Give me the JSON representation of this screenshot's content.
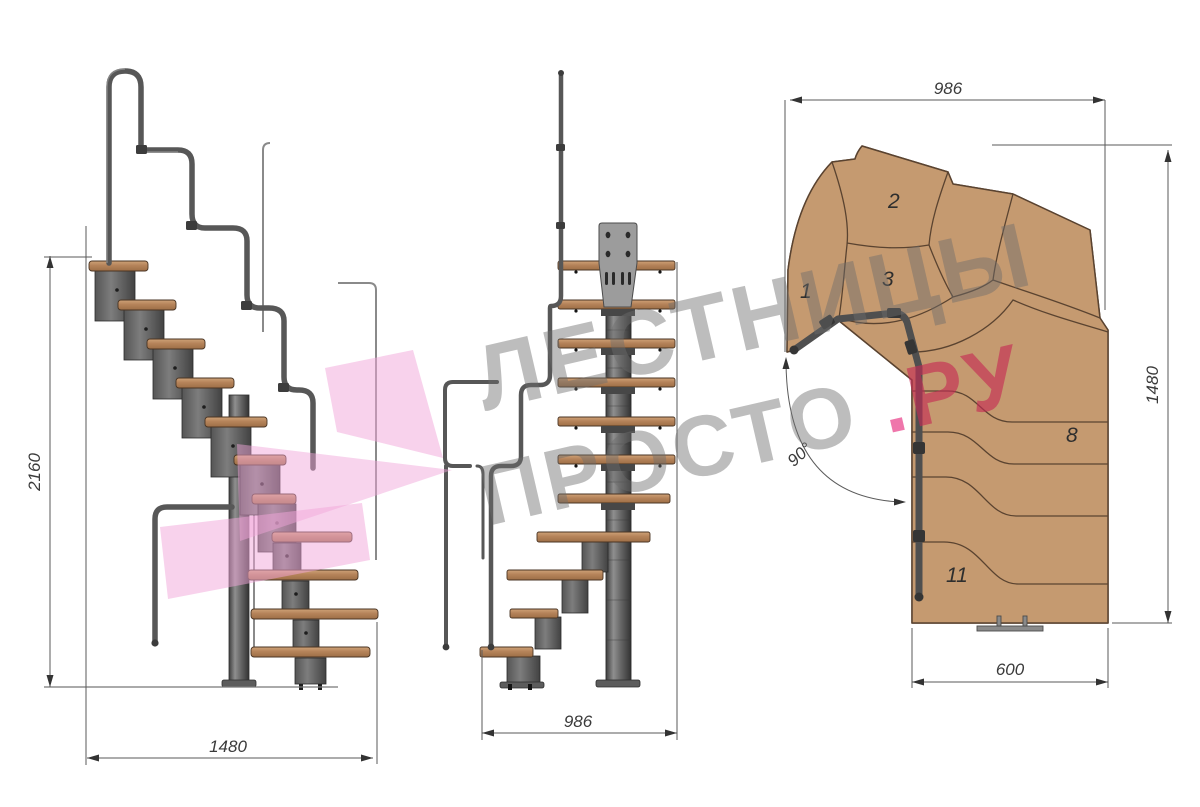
{
  "canvas": {
    "width": 1200,
    "height": 807,
    "background": "#ffffff"
  },
  "watermark": {
    "line1": "ЛЕСТНИЦЫ",
    "line2": "ПРОСТО",
    "dot": ".",
    "suffix": "РУ",
    "text_color": "#6c6c6c",
    "dot_color": "#ee6fa7",
    "suffix_color": "#c52a54",
    "logo_pink": "#f1a6da"
  },
  "views": {
    "side": {
      "dimensions": {
        "height": "2160",
        "width": "1480"
      }
    },
    "front": {
      "dimensions": {
        "width": "986"
      }
    },
    "plan": {
      "dimensions": {
        "top_width": "986",
        "right_height": "1480",
        "bottom_width": "600",
        "turn_angle": "90°"
      },
      "step_labels": [
        "1",
        "2",
        "3",
        "8",
        "11"
      ]
    }
  },
  "colors": {
    "wood_top": "#c59a70",
    "wood_edge": "#b5835a",
    "wood_outline": "#5a4330",
    "metal_dark": "#4a4a4a",
    "metal_mid": "#6e6e6e",
    "metal_light": "#9a9a9a",
    "plate_gray": "#9c9c9c",
    "dim_line": "#5a5a5a"
  }
}
